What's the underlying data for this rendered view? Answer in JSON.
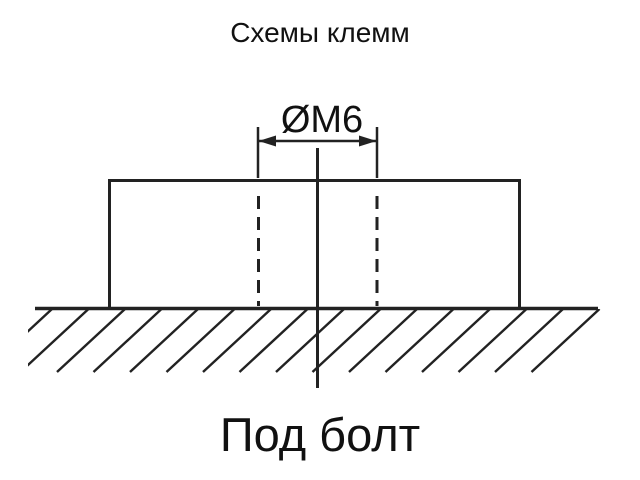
{
  "title": "Схемы клемм",
  "diagram": {
    "dimension_label": "ØM6",
    "caption": "Под болт"
  },
  "colors": {
    "line": "#222222",
    "text": "#111111",
    "background": "#ffffff"
  }
}
